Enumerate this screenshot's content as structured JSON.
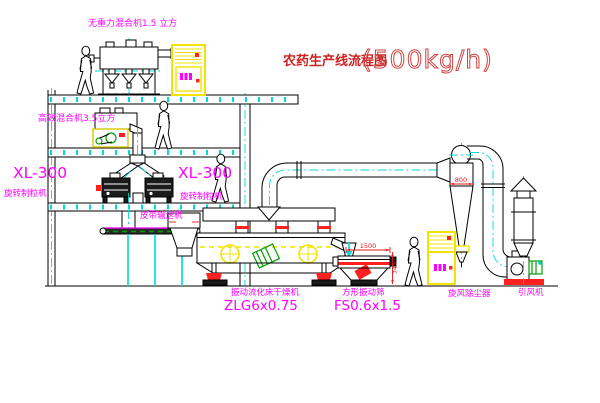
{
  "title": {
    "text": "农药生产线流程图",
    "capacity": "(500kg/h)"
  },
  "labels": {
    "gravity_mixer": "无重力混合机1.5 立方",
    "efficiency_mixer": "高效混合机3.5立方",
    "granulator_left_model": "XL-300",
    "granulator_left_name": "旋转制粒机",
    "granulator_right_model": "XL-300",
    "granulator_right_name": "旋转制粒机",
    "belt_conveyor": "皮带输送机",
    "dryer_name": "振动流化床干燥机",
    "dryer_model": "ZLG6x0.75",
    "sieve_name": "方形振动筛",
    "sieve_model": "FS0.6x1.5",
    "cyclone_name": "旋风除尘器",
    "fan_name": "引风机"
  },
  "dimensions": {
    "cyclone_inlet": "800",
    "sieve_length": "1500",
    "sieve_height": "345"
  },
  "colors": {
    "label_magenta": "#FF00FF",
    "title_red": "#CC2222",
    "centerline_cyan": "#00D9D9",
    "cabinet_yellow": "#F2E400",
    "motor_green": "#00A000",
    "accent_red": "#FF2020",
    "line_black": "#000000"
  }
}
